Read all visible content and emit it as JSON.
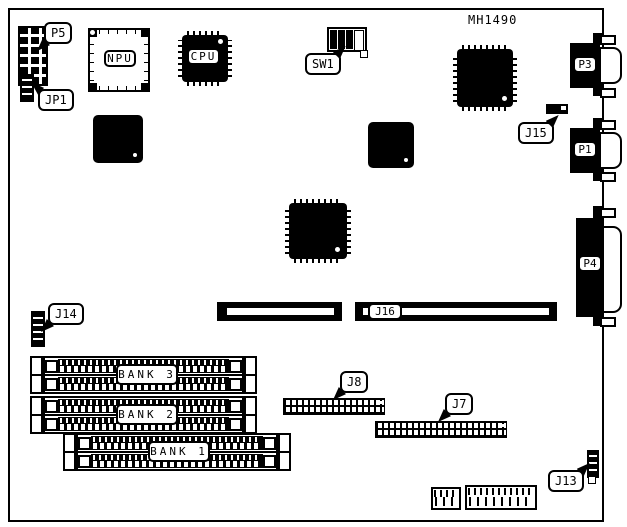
{
  "board": {
    "model": "MH1490",
    "chips": {
      "npu": "NPU",
      "cpu": "CPU"
    },
    "callouts": {
      "p5": "P5",
      "jp1": "JP1",
      "sw1": "SW1",
      "j15": "J15",
      "j14": "J14",
      "j16": "J16",
      "j8": "J8",
      "j7": "J7",
      "j13": "J13"
    },
    "ports": {
      "p3": "P3",
      "p1": "P1",
      "p4": "P4"
    },
    "memory_banks": {
      "bank3": "BANK 3",
      "bank2": "BANK 2",
      "bank1": "BANK 1"
    },
    "colors": {
      "ink": "#000000",
      "board": "#ffffff"
    }
  }
}
